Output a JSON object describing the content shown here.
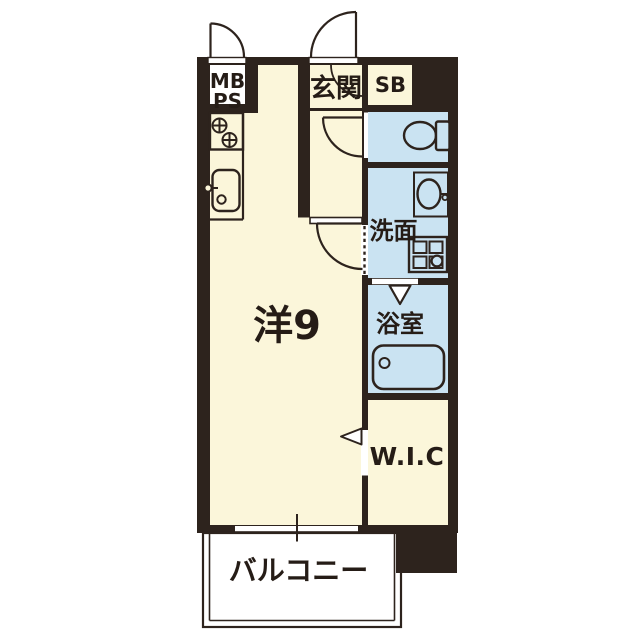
{
  "floorplan": {
    "rooms": {
      "meter_box": {
        "line1": "MB",
        "line2": "PS"
      },
      "entrance": {
        "label": "玄関"
      },
      "shoe_box": {
        "label": "SB"
      },
      "washroom": {
        "label": "洗面"
      },
      "bathroom": {
        "label": "浴室"
      },
      "main_room": {
        "label": "洋9"
      },
      "walk_in_closet": {
        "label": "W.I.C"
      },
      "balcony": {
        "label": "バルコニー"
      }
    },
    "palette": {
      "wall": "#2d231d",
      "cream": "#fbf6da",
      "blue": "#cae3f2",
      "white": "#ffffff",
      "text": "#251c16"
    }
  }
}
